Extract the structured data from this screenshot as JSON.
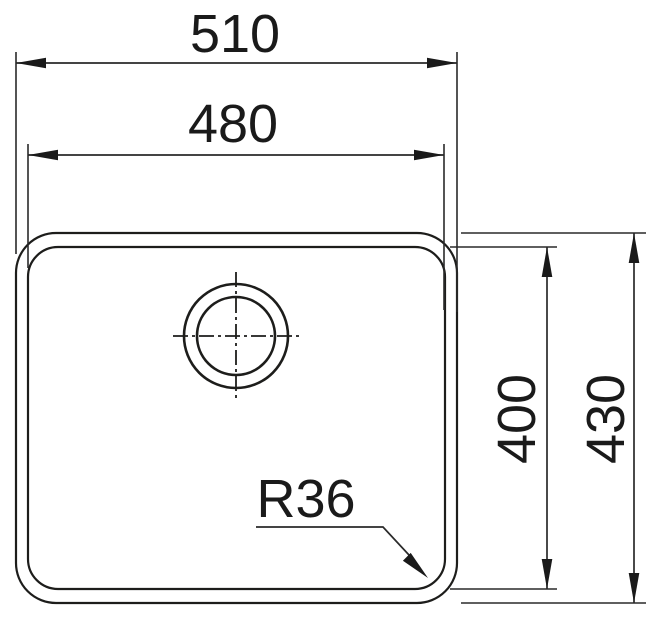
{
  "drawing": {
    "labels": {
      "outer_width": "510",
      "inner_width": "480",
      "inner_height": "400",
      "outer_height": "430",
      "corner_radius": "R36"
    },
    "colors": {
      "line": "#1d1d1b",
      "text": "#1a1a1a",
      "background": "#ffffff"
    }
  }
}
